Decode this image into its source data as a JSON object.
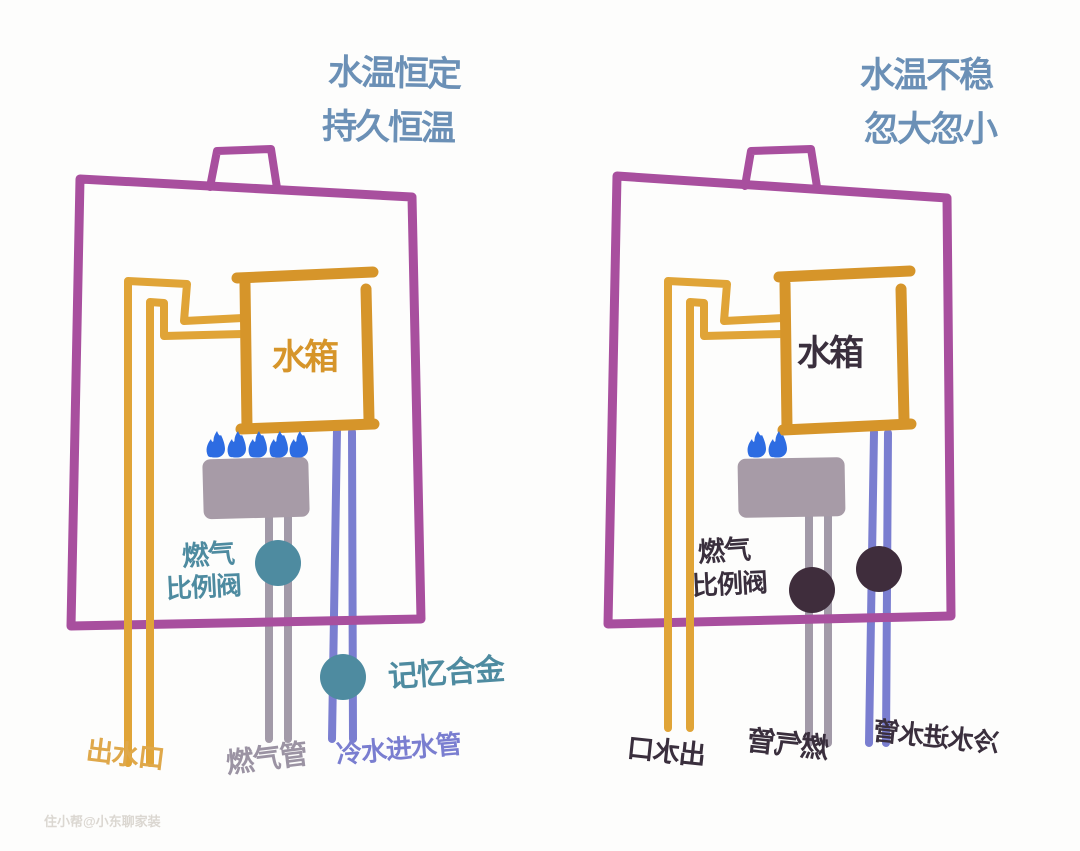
{
  "left_diagram": {
    "title_line1": "水温恒定",
    "title_line2": "持久恒温",
    "tank_label": "水箱",
    "valve_label_line1": "燃气",
    "valve_label_line2": "比例阀",
    "memory_alloy_label": "记忆合金",
    "outlet_label": "出水口",
    "gas_pipe_label": "燃气管",
    "cold_water_label": "冷水进水管",
    "flame_count": 5
  },
  "right_diagram": {
    "title_line1": "水温不稳",
    "title_line2": "忽大忽小",
    "tank_label": "水箱",
    "valve_label_line1": "燃气",
    "valve_label_line2": "比例阀",
    "outlet_label": "出水口",
    "gas_pipe_label": "燃气管",
    "cold_water_label": "冷水进水管",
    "flame_count": 2
  },
  "watermark": "住小帮@小东聊家装",
  "colors": {
    "case_outline": "#a84f9e",
    "tank_outline": "#d6952a",
    "outlet_pipe": "#e0a437",
    "gas_pipe": "#a29aa8",
    "cold_water_pipe": "#7a7ed0",
    "burner": "#a79ba7",
    "flame": "#2d6ce2",
    "teal_valve": "#4e8ba0",
    "dark_valve": "#3f2d3c",
    "title_text": "#6b90b6"
  }
}
